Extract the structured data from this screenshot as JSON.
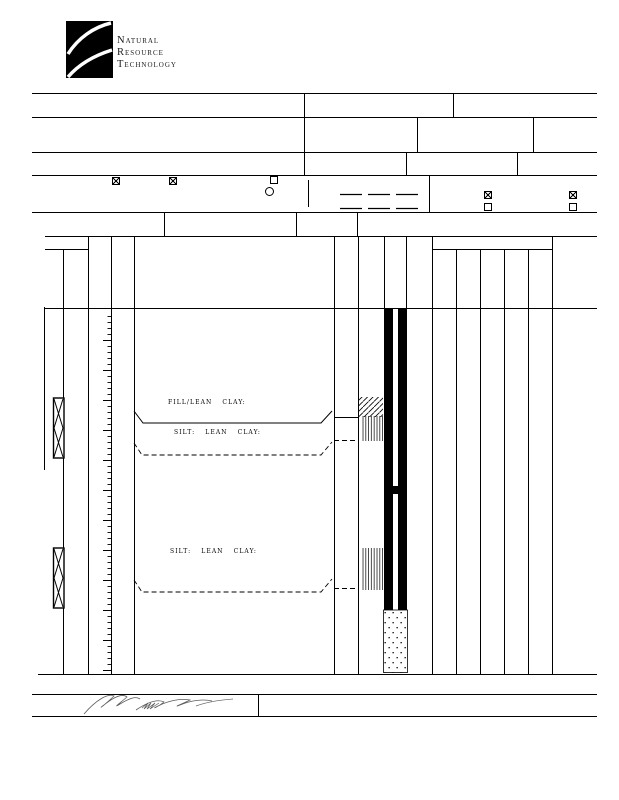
{
  "page": {
    "paper_color": "#ffffff",
    "ink_color": "#000000",
    "signature_ink_color": "#4a4a4a"
  },
  "logo": {
    "company_lines": [
      "Natural",
      "Resource",
      "Technology"
    ]
  },
  "form": {
    "checkboxes": [
      {
        "id": "header-checkbox-1",
        "state": "checked"
      },
      {
        "id": "header-checkbox-2",
        "state": "checked"
      },
      {
        "id": "header-checkbox-3",
        "state": "unchecked"
      },
      {
        "id": "header-checkbox-4",
        "state": "checked"
      },
      {
        "id": "header-checkbox-5",
        "state": "unchecked"
      },
      {
        "id": "header-checkbox-6",
        "state": "checked"
      },
      {
        "id": "header-checkbox-7",
        "state": "unchecked"
      }
    ]
  },
  "log": {
    "layers": [
      {
        "label": "FILL/LEAN CLAY:"
      },
      {
        "label": "SILT: LEAN CLAY:"
      },
      {
        "label": "SILT: LEAN CLAY:"
      }
    ]
  }
}
